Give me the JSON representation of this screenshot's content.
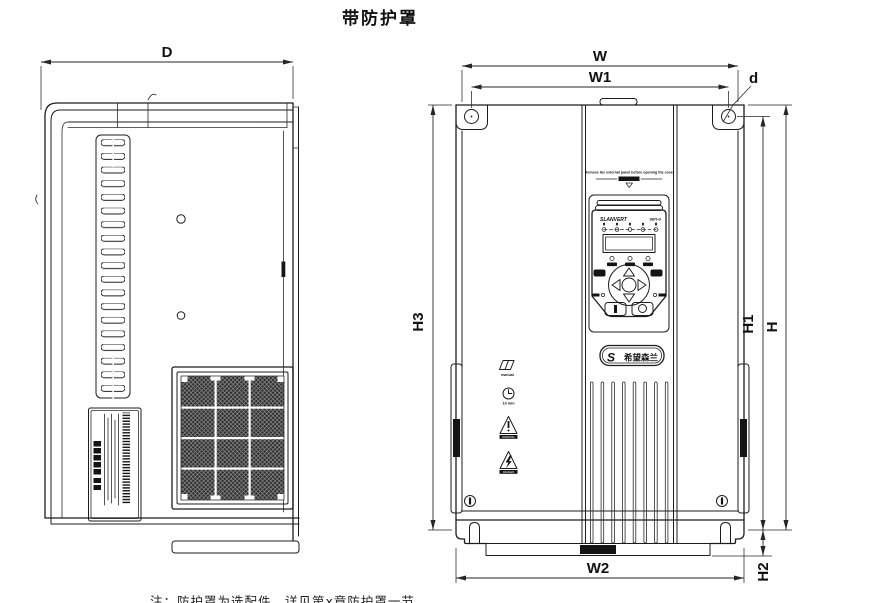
{
  "title": "带防护罩",
  "footnote": "注：防护罩为选配件，详见第x章防护罩一节",
  "dims": {
    "D": "D",
    "W": "W",
    "W1": "W1",
    "d": "d",
    "H3": "H3",
    "H1": "H1",
    "H": "H",
    "H2": "H2",
    "W2": "W2"
  },
  "front": {
    "cover_warning": "Remove the external panel before opening the cover",
    "keypad": {
      "brand": "SLANVERT",
      "model": "SB70-G"
    },
    "labels": {
      "manual": "manual",
      "timer": "10 min",
      "warning": "WARNING",
      "danger": "DANGER"
    },
    "logo_text": "希望森兰"
  }
}
